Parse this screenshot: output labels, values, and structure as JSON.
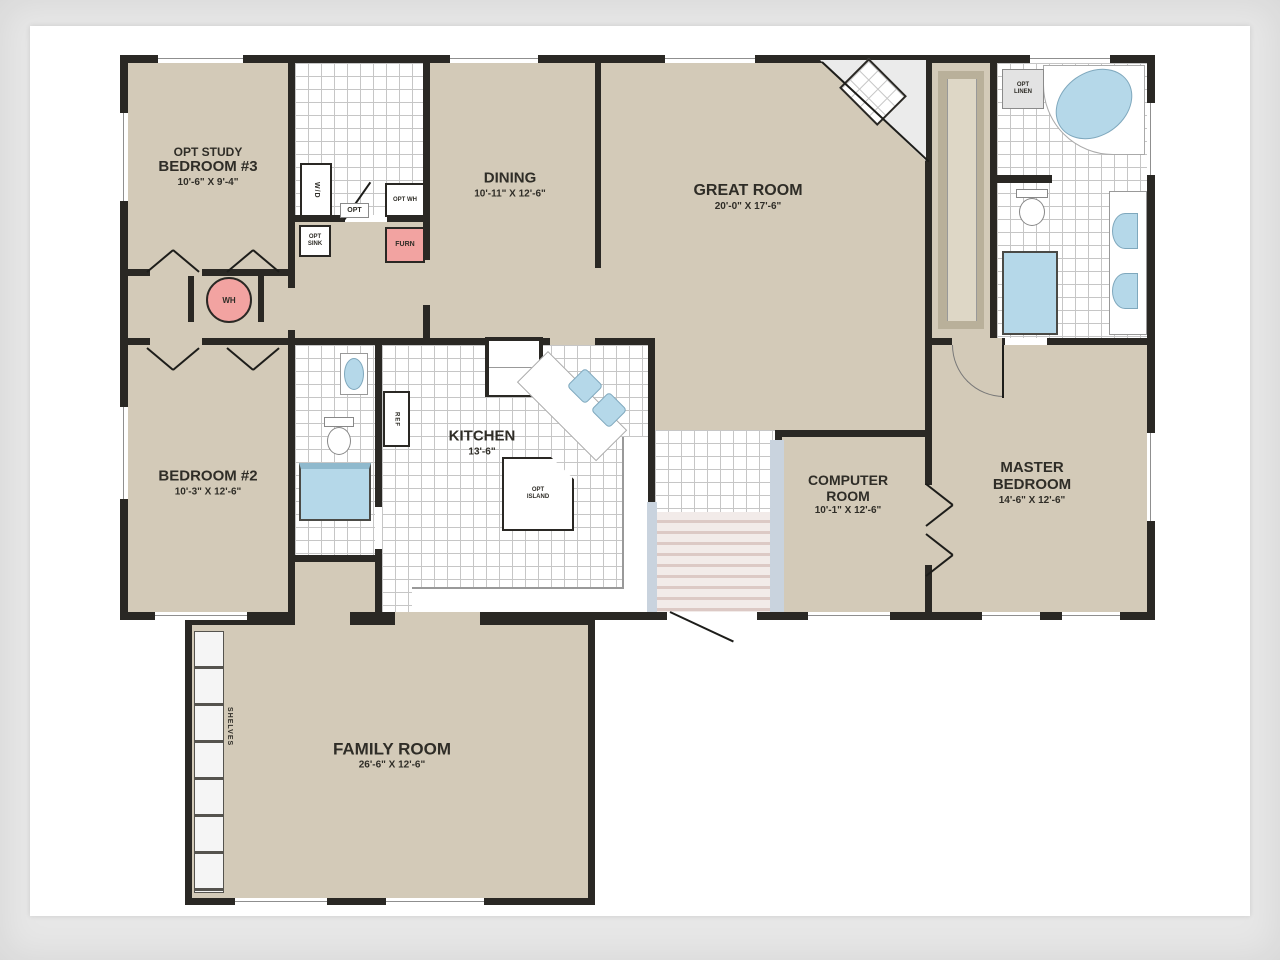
{
  "plan_title": "Modular Home Floor Plan",
  "rooms": {
    "bedroom3": {
      "prefix": "OPT STUDY",
      "name": "BEDROOM #3",
      "dims": "10'-6\" X 9'-4\""
    },
    "dining": {
      "name": "DINING",
      "dims": "10'-11\" X 12'-6\""
    },
    "great_room": {
      "name": "GREAT ROOM",
      "dims": "20'-0\" X 17'-6\""
    },
    "bedroom2": {
      "name": "BEDROOM #2",
      "dims": "10'-3\" X 12'-6\""
    },
    "kitchen": {
      "name": "KITCHEN",
      "dims": "13'-6\""
    },
    "computer_room": {
      "name": "COMPUTER",
      "name2": "ROOM",
      "dims": "10'-1\" X 12'-6\""
    },
    "master_bedroom": {
      "name": "MASTER",
      "name2": "BEDROOM",
      "dims": "14'-6\" X 12'-6\""
    },
    "family_room": {
      "name": "FAMILY ROOM",
      "dims": "26'-6\" X 12'-6\""
    }
  },
  "fixtures": {
    "furnace": "FURN",
    "water_heater": "WH",
    "washer_dryer": "W/D",
    "opt_door": "OPT",
    "opt_wh": "OPT WH",
    "opt_sink": "OPT SINK",
    "linen": "OPT LINEN",
    "island": "OPT ISLAND",
    "refrigerator": "REF",
    "shelves": "SHELVES"
  },
  "palette": {
    "wall": "#2a2824",
    "carpet": "#d3cab8",
    "tile_line": "#c6c6c6",
    "fixture_blue": "#b5d8e9",
    "furnace_pink": "#f2a3a1",
    "stair_stripe": "#dcc9c5",
    "frame_gray": "#e7e7e7"
  }
}
